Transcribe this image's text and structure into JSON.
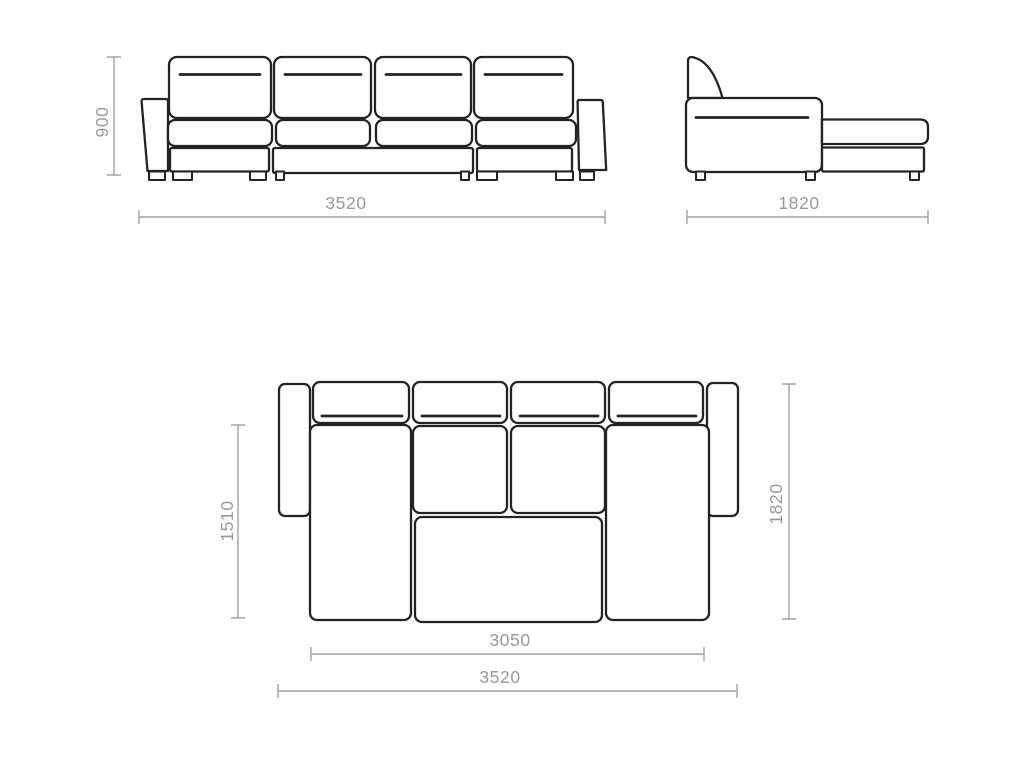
{
  "colors": {
    "background": "#ffffff",
    "outline": "#232323",
    "dimension": "#a2a3a5",
    "label": "#98999c"
  },
  "views": {
    "front": {
      "title": "sofa front elevation",
      "dimensions": {
        "height": "900",
        "width": "3520"
      }
    },
    "side": {
      "title": "sofa side elevation with chaise",
      "dimensions": {
        "depth": "1820"
      }
    },
    "plan": {
      "title": "sofa top plan",
      "dimensions": {
        "seat_depth": "1510",
        "depth": "1820",
        "inner_width": "3050",
        "width": "3520"
      }
    }
  }
}
